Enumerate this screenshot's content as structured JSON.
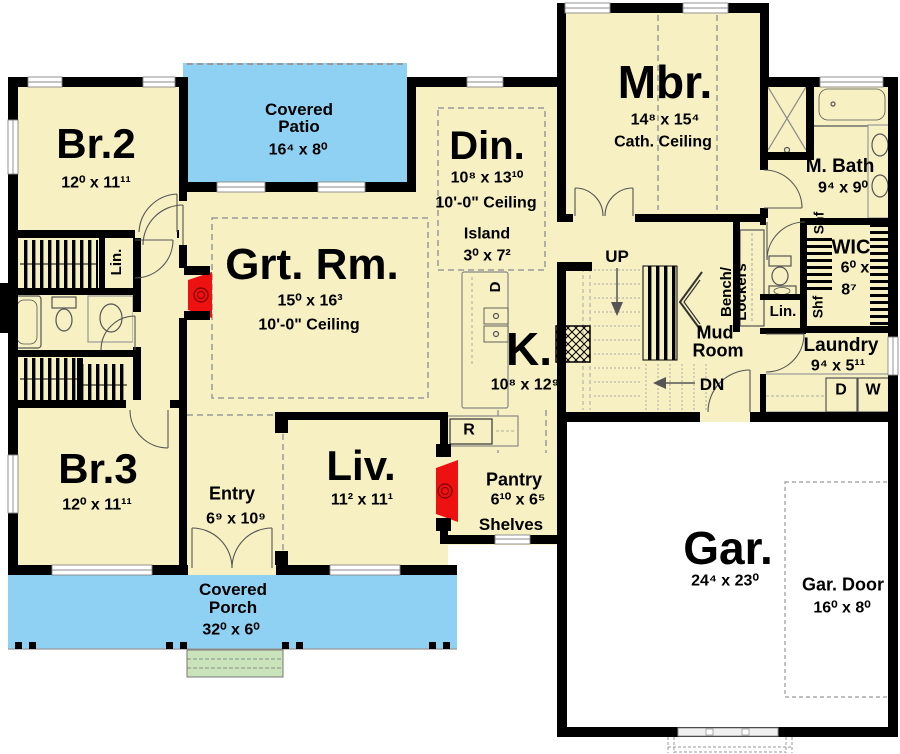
{
  "title": "First floor plan",
  "colors": {
    "floor": "#F6F0C2",
    "outdoor_blue": "#8FD1F3",
    "steps_green": "#C9E3BA",
    "fireplace_red": "#EE1111",
    "wall": "#000000",
    "garage_floor": "#FFFFFF"
  },
  "rooms": {
    "br2": {
      "name": "Br.2",
      "dims": "12⁰ x 11¹¹"
    },
    "br3": {
      "name": "Br.3",
      "dims": "12⁰ x 11¹¹"
    },
    "grt": {
      "name": "Grt. Rm.",
      "dims": "15⁰ x 16³",
      "ceiling": "10'-0\" Ceiling"
    },
    "liv": {
      "name": "Liv.",
      "dims": "11² x 11¹"
    },
    "din": {
      "name": "Din.",
      "dims": "10⁸ x 13¹⁰",
      "ceiling": "10'-0\" Ceiling"
    },
    "kitchen": {
      "name": "K.",
      "dims": "10⁸ x 12⁹"
    },
    "island": {
      "name": "Island",
      "dims": "3⁰ x 7²"
    },
    "mbr": {
      "name": "Mbr.",
      "dims": "14⁸ x 15⁴",
      "ceiling": "Cath. Ceiling"
    },
    "mbath": {
      "name": "M. Bath",
      "dims": "9⁴ x 9⁰"
    },
    "wic": {
      "name": "WIC",
      "dims_line1": "6⁰ x",
      "dims_line2": "8⁷"
    },
    "laundry": {
      "name": "Laundry",
      "dims": "9⁴ x 5¹¹"
    },
    "mud": {
      "line1": "Mud",
      "line2": "Room"
    },
    "entry": {
      "name": "Entry",
      "dims": "6⁹ x 10⁹"
    },
    "pantry": {
      "name": "Pantry",
      "dims": "6¹⁰ x 6⁵",
      "note": "Shelves"
    },
    "patio": {
      "line1": "Covered",
      "line2": "Patio",
      "dims": "16⁴ x 8⁰"
    },
    "porch": {
      "line1": "Covered",
      "line2": "Porch",
      "dims": "32⁰ x 6⁰"
    },
    "garage": {
      "name": "Gar.",
      "dims": "24⁴ x 23⁰"
    },
    "gardoor": {
      "name": "Gar. Door",
      "dims": "16⁰ x 8⁰"
    }
  },
  "annotations": {
    "up": "UP",
    "dn": "DN",
    "lin": "Lin.",
    "shf": "Shf",
    "bench_line1": "Bench/",
    "bench_line2": "Lockers",
    "dishwasher": "D",
    "dryer": "D",
    "washer": "W",
    "range": "R"
  }
}
